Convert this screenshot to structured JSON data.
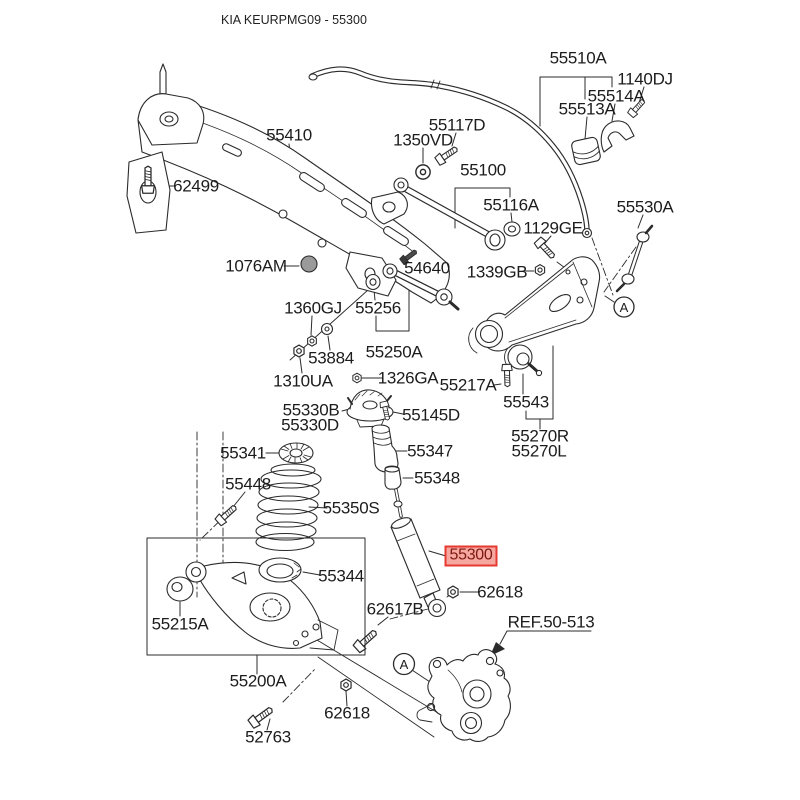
{
  "title": "KIA KEURPMG09 - 55300",
  "highlighted_part": "55300",
  "colors": {
    "line": "#2b2b2b",
    "highlight_bg": "#F5A7A0",
    "highlight_border": "#E63A30",
    "highlight_text": "#7E170E"
  },
  "callouts": {
    "a": "A"
  },
  "labels": {
    "t55510a": "55510A",
    "t1140dj": "1140DJ",
    "t55514a": "55514A",
    "t55513a": "55513A",
    "t55117d": "55117D",
    "t1350vd": "1350VD",
    "t55100": "55100",
    "t55410": "55410",
    "t62499": "62499",
    "t55116a": "55116A",
    "t55530a": "55530A",
    "t1129ge": "1129GE",
    "t1076am": "1076AM",
    "t54640": "54640",
    "t1339gb": "1339GB",
    "t55256": "55256",
    "t1360gj": "1360GJ",
    "t53884": "53884",
    "t55250a": "55250A",
    "t1310ua": "1310UA",
    "t1326ga": "1326GA",
    "t55217a": "55217A",
    "t55330b": "55330B",
    "t55330d": "55330D",
    "t55145d": "55145D",
    "t55543": "55543",
    "t55270r": "55270R",
    "t55270l": "55270L",
    "t55341": "55341",
    "t55347": "55347",
    "t55448": "55448",
    "t55348": "55348",
    "t55350s": "55350S",
    "t55300": "55300",
    "t55344": "55344",
    "t62618": "62618",
    "t55215a": "55215A",
    "t62617b": "62617B",
    "tref": "REF.50-513",
    "t55200a": "55200A",
    "t52763": "52763"
  }
}
